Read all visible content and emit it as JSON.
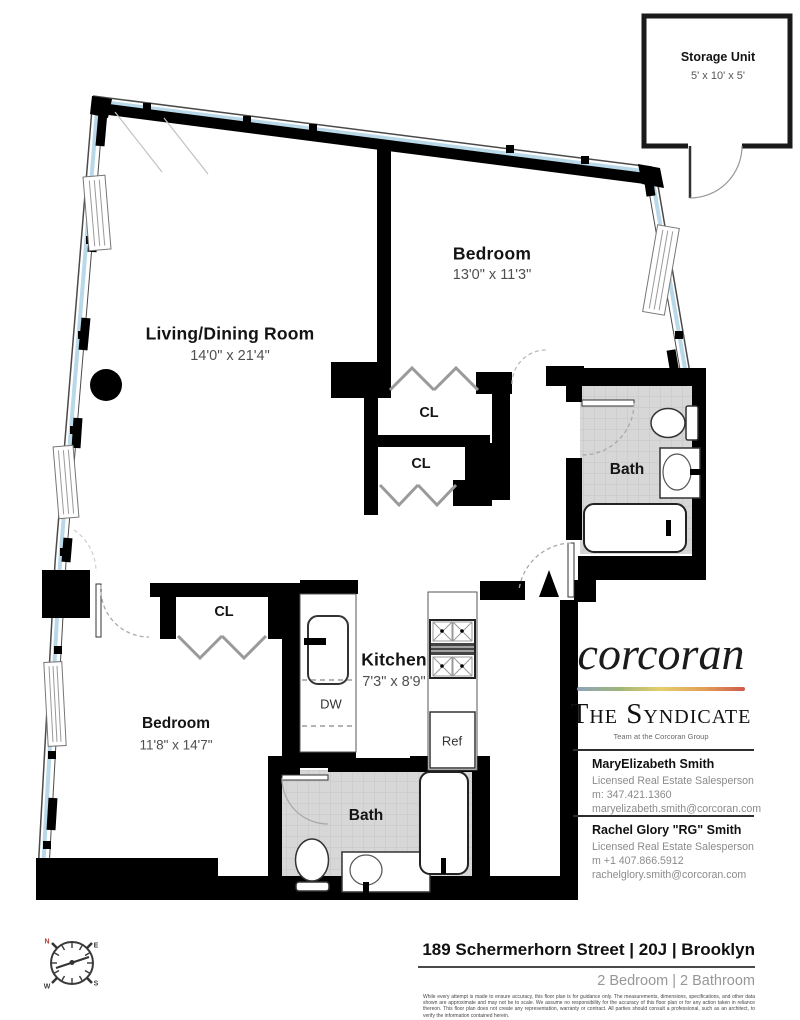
{
  "plan": {
    "storage": {
      "label": "Storage Unit",
      "dims": "5' x 10' x 5'"
    },
    "bedroom1": {
      "label": "Bedroom",
      "dims": "13'0\" x 11'3\""
    },
    "living": {
      "label": "Living/Dining Room",
      "dims": "14'0\" x 21'4\""
    },
    "kitchen": {
      "label": "Kitchen",
      "dims": "7'3\" x 8'9\""
    },
    "bedroom2": {
      "label": "Bedroom",
      "dims": "11'8\" x 14'7\""
    },
    "bath1": {
      "label": "Bath"
    },
    "bath2": {
      "label": "Bath"
    },
    "closet1": {
      "label": "CL"
    },
    "closet2": {
      "label": "CL"
    },
    "closet3": {
      "label": "CL"
    },
    "dishwasher": {
      "label": "DW"
    },
    "refrigerator": {
      "label": "Ref"
    }
  },
  "compass": {
    "n": "N",
    "e": "E",
    "s": "S",
    "w": "W"
  },
  "branding": {
    "logo": "corcoran",
    "team": "The Syndicate",
    "tagline": "Team at the Corcoran Group",
    "gradient": [
      "#8fa3b8",
      "#9fb57b",
      "#e5cf6a",
      "#e2a057",
      "#cf5a4e"
    ]
  },
  "agents": [
    {
      "name": "MaryElizabeth Smith",
      "title": "Licensed Real Estate Salesperson",
      "phone": "m: 347.421.1360",
      "email": "maryelizabeth.smith@corcoran.com"
    },
    {
      "name": "Rachel Glory \"RG\" Smith",
      "title": "Licensed Real Estate Salesperson",
      "phone": "m +1 407.866.5912",
      "email": "rachelglory.smith@corcoran.com"
    }
  ],
  "footer": {
    "address": "189 Schermerhorn Street | 20J | Brooklyn",
    "summary": "2 Bedroom | 2 Bathroom",
    "disclaimer": "While every attempt is made to ensure accuracy, this floor plan is for guidance only. The measurements, dimensions, specifications, and other data shown are approximate and may not be to scale. We assume no responsibility for the accuracy of this floor plan or for any action taken in reliance thereon. This floor plan does not create any representation, warranty or contract. All parties should consult a professional, such as an architect, to verify the information contained herein."
  },
  "colors": {
    "wall": "#000000",
    "window_glass": "#b9d9e8",
    "tile": "#d7d7d7"
  }
}
